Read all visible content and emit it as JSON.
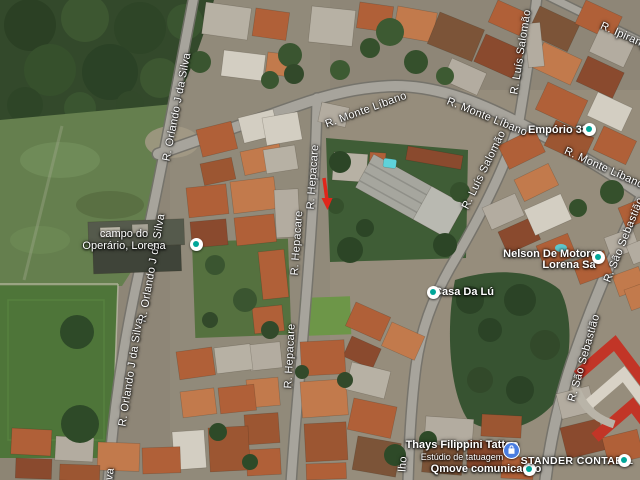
{
  "map": {
    "view": "satellite",
    "streets": {
      "monte_libano": "R. Monte Líbano",
      "hepacare": "R. Hepacare",
      "orlando_j_da_silva": "R. Orlando J da Silva",
      "luis_salomao": "R. Luís Salomão",
      "ipiranga": "R. Ipiranga",
      "sao_sebastiao": "R. São Sebastião"
    },
    "street_fragments": {
      "orlando_end": "va",
      "lho": "lho"
    },
    "pois": {
      "campo": {
        "line1": "campo do",
        "line2": "Operário, Lorena",
        "marker": "white-teal-dot"
      },
      "emporio": {
        "name": "Empório 38",
        "marker": "white-teal-dot"
      },
      "nelson": {
        "line1": "Nelson De Motores",
        "line2": "Lorena Sa",
        "marker": "white-teal-dot"
      },
      "casa_da_lu": {
        "name": "Casa Da Lú",
        "marker": "white-teal-dot"
      },
      "thays": {
        "line1": "Thays Filippini Tattoo",
        "line2": "Estúdio de tatuagem",
        "marker": "blue-shopping-bag"
      },
      "qmove": {
        "name": "Qmove comunicação",
        "marker": "white-teal-dot"
      },
      "stander": {
        "name": "STANDER CONTABIL",
        "marker": "white-teal-dot"
      }
    },
    "annotations": {
      "red_arrow": {
        "shape": "arrow-down",
        "location": "over R. Hepacare vacant lot",
        "color": "#e0261a"
      }
    },
    "colors": {
      "poi_dot_teal": "#00a699",
      "thays_marker_blue": "#4a7de0",
      "red_arrow": "#e0261a",
      "logo_red": "#c23527",
      "road_gray": "#a7a49c",
      "field_green": "#4e7539",
      "forest_green": "#33492b",
      "roof_orange": "#b06038"
    }
  }
}
